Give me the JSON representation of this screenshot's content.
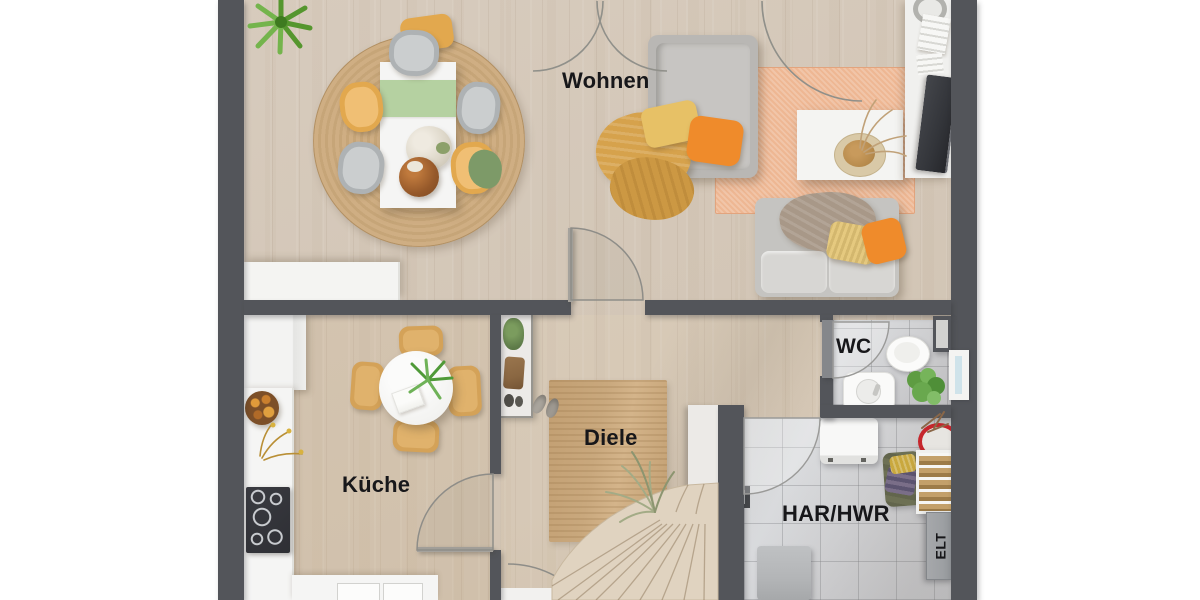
{
  "plan": {
    "type": "residential floor plan, top-down 3D render",
    "rooms": {
      "living": {
        "label": "Wohnen"
      },
      "kitchen": {
        "label": "Küche"
      },
      "hallway": {
        "label": "Diele"
      },
      "wc": {
        "label": "WC"
      },
      "utility": {
        "label": "HAR/HWR"
      },
      "electrical": {
        "label": "ELT"
      }
    }
  },
  "colors": {
    "wall": "#53555a",
    "wood": "#d7cbbd",
    "tile": "#d5d6d9",
    "jute": "#c9a87d",
    "orange_rug": "#eeb793",
    "mustard": "#e2a84e",
    "orange": "#ef8b2b",
    "green_runner": "#b5d1a1",
    "red": "#c6262c",
    "label": "#17171a"
  }
}
